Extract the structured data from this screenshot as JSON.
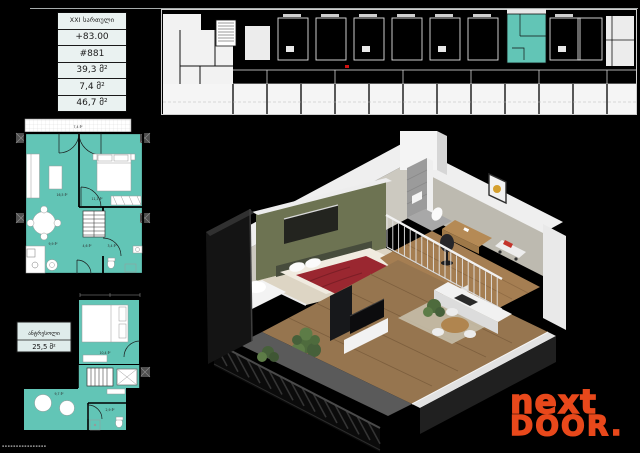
{
  "info_table": {
    "rows": [
      "XXI სართული",
      "+83.00",
      "#881",
      "39,3 მ²",
      "7,4 მ²",
      "46,7 მ²"
    ]
  },
  "upper_plan": {
    "balcony_area": "7,4 მ²",
    "living_area": "16,5 მ²",
    "bedroom_area": "11,1 მ²",
    "kitchen_area": "9,9 მ²",
    "hall_area": "4,6 მ²",
    "bath_area": "3,4 მ²"
  },
  "mezzanine_plan": {
    "label_title": "ანტრესოლი",
    "label_area": "25,5 მ²",
    "bedroom_area": "10,4 მ²",
    "lounge_area": "9,7 მ²",
    "bath_area": "2,9 მ²"
  },
  "logo": {
    "line1": "next",
    "line2": "DOOR."
  },
  "watermark": {
    "text": "▪▪▪▪▪▪▪▪▪▪▪▪▪▪▪▪"
  },
  "colors": {
    "highlight": "#62c5b6",
    "orange": "#e8481b",
    "tablebg": "#eaf2f1"
  }
}
